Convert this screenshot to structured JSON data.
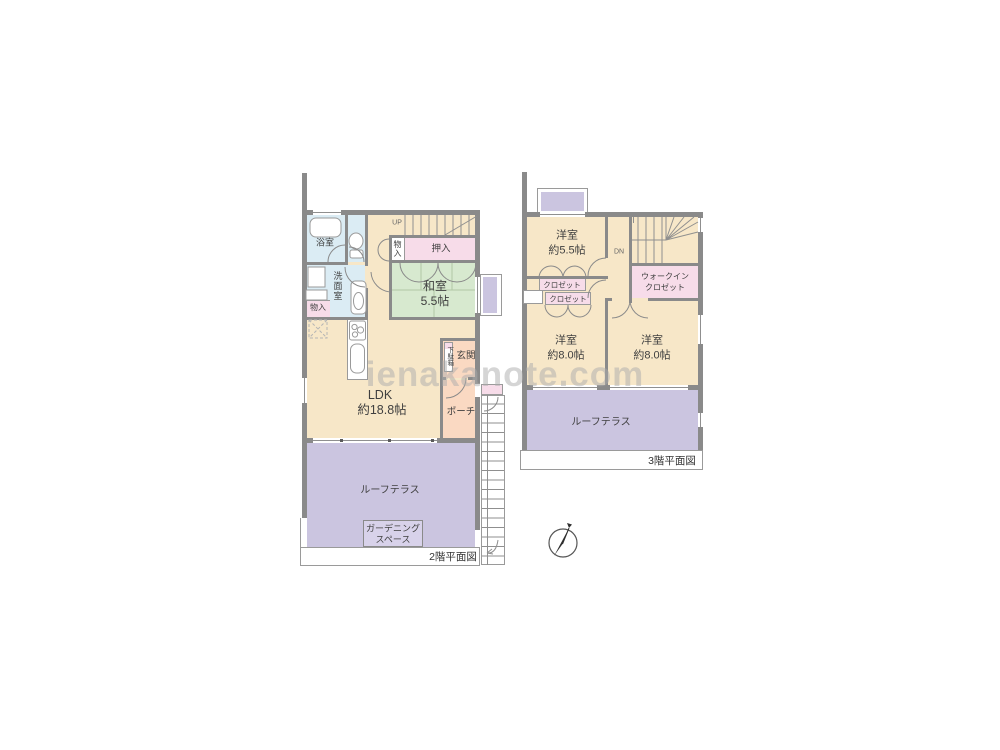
{
  "watermark": "ienakanote.com",
  "floor2": {
    "title": "2階平面図",
    "bath": "浴室",
    "washroom": "洗面室",
    "storage_washroom": "物入",
    "storage_hall": "物入",
    "up": "UP",
    "oshiire": "押入",
    "washitsu_name": "和室",
    "washitsu_size": "5.5帖",
    "ldk_name": "LDK",
    "ldk_size": "約18.8帖",
    "getabako": "下駄箱",
    "genkan": "玄関",
    "porch": "ポーチ",
    "terrace": "ルーフテラス",
    "gardening_line1": "ガーデニング",
    "gardening_line2": "スペース"
  },
  "floor3": {
    "title": "3階平面図",
    "dn": "DN",
    "room1_name": "洋室",
    "room1_size": "約5.5帖",
    "wic_line1": "ウォークイン",
    "wic_line2": "クロゼット",
    "closet1": "クロゼット",
    "closet2": "クロゼット",
    "room2_name": "洋室",
    "room2_size": "約8.0帖",
    "room3_name": "洋室",
    "room3_size": "約8.0帖",
    "terrace": "ルーフテラス"
  },
  "colors": {
    "room": "#F7E7C8",
    "tatami": "#D7E9CF",
    "closet_pink": "#F7DCE9",
    "wet_blue": "#DBECF4",
    "terrace_purple": "#CBC5E0",
    "entrance_peach": "#FAD9C2",
    "wall_gray": "#8A8A8A"
  }
}
